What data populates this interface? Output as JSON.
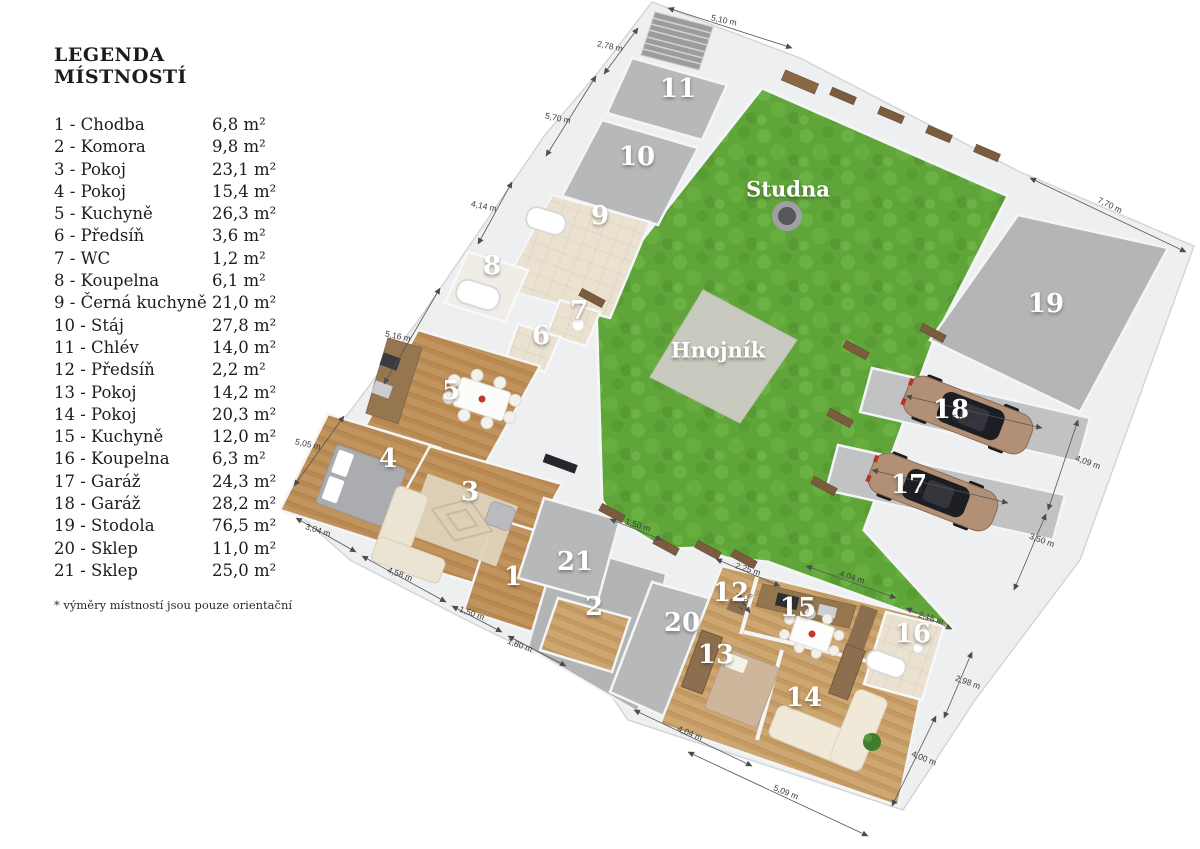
{
  "legend": {
    "title": "LEGENDA MÍSTNOSTÍ",
    "separator": " - ",
    "items": [
      {
        "num": "1",
        "name": "Chodba",
        "area": "6,8 m²"
      },
      {
        "num": "2",
        "name": "Komora",
        "area": "9,8 m²"
      },
      {
        "num": "3",
        "name": "Pokoj",
        "area": "23,1 m²"
      },
      {
        "num": "4",
        "name": "Pokoj",
        "area": "15,4 m²"
      },
      {
        "num": "5",
        "name": "Kuchyně",
        "area": "26,3 m²"
      },
      {
        "num": "6",
        "name": "Předsíň",
        "area": "3,6 m²"
      },
      {
        "num": "7",
        "name": "WC",
        "area": "1,2 m²"
      },
      {
        "num": "8",
        "name": "Koupelna",
        "area": "6,1 m²"
      },
      {
        "num": "9",
        "name": "Černá kuchyně",
        "area": "21,0 m²"
      },
      {
        "num": "10",
        "name": "Stáj",
        "area": "27,8 m²"
      },
      {
        "num": "11",
        "name": "Chlév",
        "area": "14,0 m²"
      },
      {
        "num": "12",
        "name": "Předsíň",
        "area": "2,2 m²"
      },
      {
        "num": "13",
        "name": "Pokoj",
        "area": "14,2 m²"
      },
      {
        "num": "14",
        "name": "Pokoj",
        "area": "20,3 m²"
      },
      {
        "num": "15",
        "name": "Kuchyně",
        "area": "12,0 m²"
      },
      {
        "num": "16",
        "name": "Koupelna",
        "area": "6,3 m²"
      },
      {
        "num": "17",
        "name": "Garáž",
        "area": "24,3 m²"
      },
      {
        "num": "18",
        "name": "Garáž",
        "area": "28,2 m²"
      },
      {
        "num": "19",
        "name": "Stodola",
        "area": "76,5 m²"
      },
      {
        "num": "20",
        "name": "Sklep",
        "area": "11,0 m²"
      },
      {
        "num": "21",
        "name": "Sklep",
        "area": "25,0 m²"
      }
    ],
    "footnote": "*  výměry místností jsou pouze orientační"
  },
  "plan": {
    "site_labels": {
      "well": "Studna",
      "manure": "Hnojník"
    },
    "dimensions": [
      "5,10 m",
      "2,78 m",
      "5,70 m",
      "4,14 m",
      "5,16 m",
      "5,05 m",
      "3,04 m",
      "4,58 m",
      "1,50 m",
      "1,80 m",
      "1,50 m",
      "2,25 m",
      "1,00 m",
      "4,04 m",
      "2,15 m",
      "7,70 m",
      "4,09 m",
      "3,50 m",
      "2,98 m",
      "4,00 m",
      "5,09 m",
      "4,04 m",
      "6,90 m",
      "6,90 m"
    ]
  }
}
